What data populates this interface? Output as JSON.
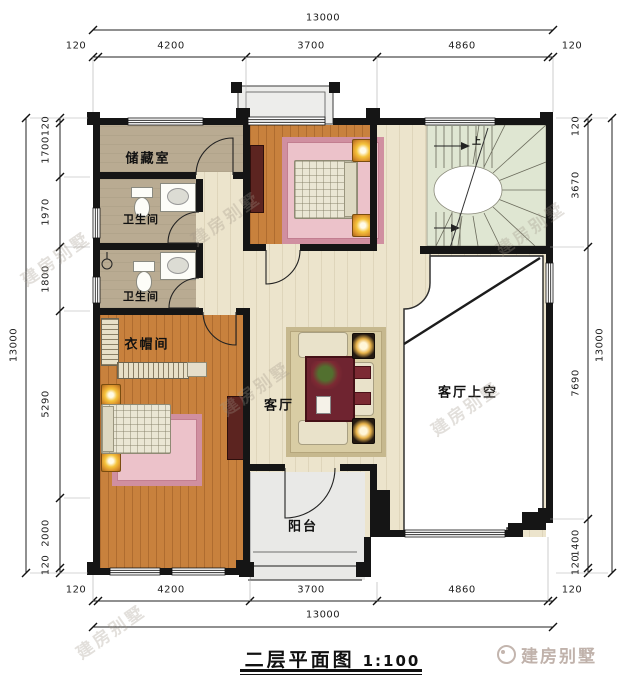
{
  "drawing": {
    "title": "二层平面图",
    "scale": "1:100"
  },
  "rooms": {
    "storage": {
      "label": "储藏室"
    },
    "bath1": {
      "label": "卫生间"
    },
    "bath2": {
      "label": "卫生间"
    },
    "cloakroom": {
      "label": "衣帽间"
    },
    "living": {
      "label": "客厅"
    },
    "living_void": {
      "label": "客厅上空"
    },
    "balcony": {
      "label": "阳台"
    },
    "stair": {
      "up_label": "上"
    }
  },
  "dimensions": {
    "top": {
      "total": "13000",
      "segments": [
        "120",
        "4200",
        "3700",
        "4860",
        "120"
      ]
    },
    "bottom": {
      "total": "13000",
      "segments": [
        "120",
        "4200",
        "3700",
        "4860",
        "120"
      ]
    },
    "left": {
      "total": "13000",
      "segments": [
        "120",
        "1700",
        "1970",
        "1800",
        "5290",
        "2000",
        "120"
      ]
    },
    "right": {
      "total": "13000",
      "segments": [
        "120",
        "3670",
        "7690",
        "1400",
        "120"
      ]
    }
  },
  "watermark": {
    "text": "建房别墅"
  },
  "logo": {
    "text": "建房别墅"
  },
  "colors": {
    "wall": "#151515",
    "wood_floor": "#c8813d",
    "light_floor": "#ece4cc",
    "tan_floor": "#b9ab92",
    "stair_tread": "#dfe6d2",
    "rug_pink": "#ecc2ca",
    "rug_pink_border": "#d08fa0",
    "accent_maroon": "#6f2430",
    "lamp_glow": "#f5c33c",
    "balcony_floor": "#e9e9e7",
    "watermark_gray": "#a89a90"
  }
}
